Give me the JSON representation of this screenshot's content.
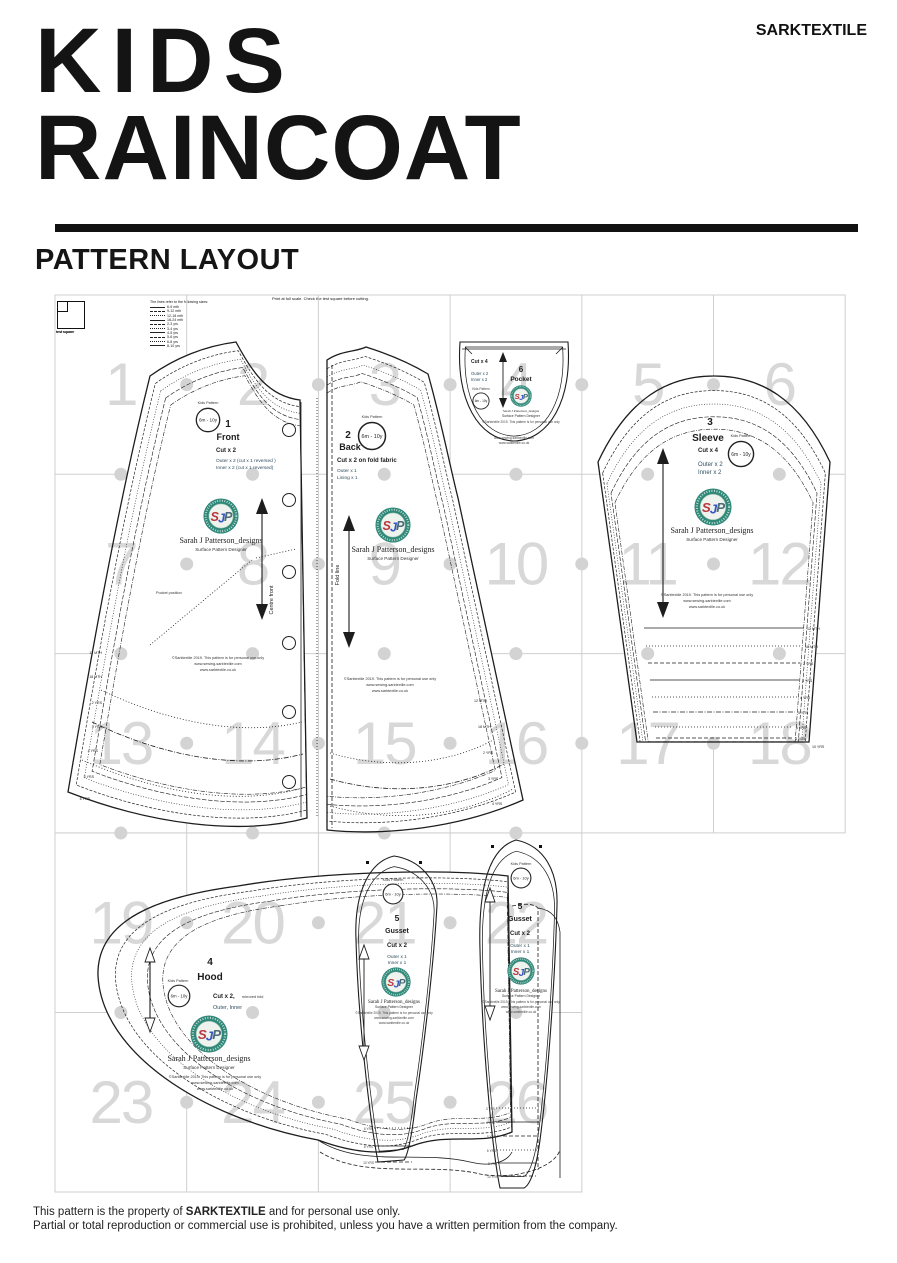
{
  "header": {
    "title_line1": "KIDS",
    "title_line2": "RAINCOAT",
    "brand": "SARKTEXTILE",
    "section_title": "PATTERN LAYOUT"
  },
  "footer": {
    "line1_prefix": "This pattern is the property of ",
    "line1_bold": "SARKTEXTILE",
    "line1_suffix": " and for personal use only.",
    "line2": "Partial or total reproduction or commercial use is prohibited, unless you have a written permition from the company."
  },
  "layout": {
    "print_note": "Print at full scale. Check the test square before cutting.",
    "scale_box_label": "test square"
  },
  "legend": {
    "title": "The lines refer to the following sizes:",
    "sizes": [
      "6-9 mth",
      "9-12 mth",
      "12-18 mth",
      "18-24 mth",
      "2-3 yrs",
      "3-4 yrs",
      "4-5 yrs",
      "5-6 yrs",
      "6-8 yrs",
      "8-10 yrs"
    ]
  },
  "grid": {
    "line_color": "#cfcfcf",
    "number_color": "#d8d8d8",
    "dot_color": "#d3d3d3",
    "areas": [
      {
        "x": 55,
        "y": 295,
        "cols": 6,
        "rows": 3,
        "cw": 131.7,
        "rh": 179.3,
        "dot_top_edge": false,
        "pages": [
          "1",
          "2",
          "3",
          "4",
          "5",
          "6",
          "7",
          "8",
          "9",
          "10",
          "11",
          "12",
          "13",
          "14",
          "15",
          "16",
          "17",
          "18"
        ]
      },
      {
        "x": 55,
        "y": 833,
        "cols": 4,
        "rows": 2,
        "cw": 131.7,
        "rh": 179.5,
        "dot_top_edge": true,
        "pages": [
          "19",
          "20",
          "21",
          "22",
          "23",
          "24",
          "25",
          "26"
        ]
      }
    ]
  },
  "common": {
    "stamp_label": "Kids Pattern",
    "stamp_code": "6m - 10y",
    "logo_letters": "SJP",
    "designer": "Sarah J Patterson_designs",
    "designer_sub": "Surface Pattern Designer",
    "copyright1": "©Sarktextile 2019. This pattern is for personal use only",
    "copyright2": "www.sewing-sarktextile.com",
    "copyright3": "www.sarktextile.co.uk"
  },
  "hem_labels": [
    "12 MTH",
    "18 MTH",
    "2 YRS",
    "3 YRS",
    "4 YRS",
    "5 YRS",
    "6 YRS",
    "8 YRS",
    "10 YRS"
  ],
  "pieces": {
    "front": {
      "number": "1",
      "name": "Front",
      "cut": "Cut x 2",
      "spec1": "Outer  x 2 (cut x 1 reversed )",
      "spec2": "Inner  x 2 (cut x 1 reversed)",
      "grain_label": "Centre front",
      "pocket_note": "Pocket position"
    },
    "back": {
      "number": "2",
      "name": "Back",
      "cut": "Cut x 2 on fold fabric",
      "spec1": "Outer x 1",
      "spec2": "Lining x 1",
      "fold_label": "Fold line"
    },
    "sleeve": {
      "number": "3",
      "name": "Sleeve",
      "cut": "Cut x 4",
      "spec1": "Outer  x 2",
      "spec2": "Inner  x 2"
    },
    "hood": {
      "number": "4",
      "name": "Hood",
      "cut": "Cut x 2,",
      "cut_note": "mirrored fold",
      "spec1": "Outer, Inner"
    },
    "gusset": {
      "number": "5",
      "name": "Gusset",
      "cut": "Cut x 2",
      "spec1": "Outer x 1",
      "spec2": "Inner x 1"
    },
    "pocket": {
      "number": "6",
      "name": "Pocket",
      "cut": "Cut x 4",
      "spec1": "Outer x 2",
      "spec2": "Inner x 2"
    }
  }
}
